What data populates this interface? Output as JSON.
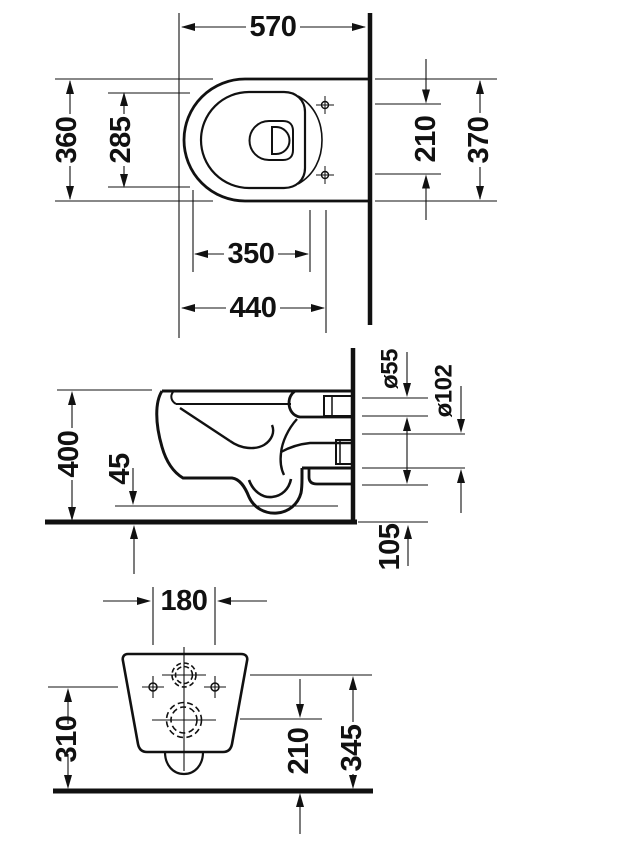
{
  "drawing": {
    "type": "technical dimension drawing",
    "subject": "wall-hung toilet",
    "line_color": "#111111",
    "background": "#ffffff"
  },
  "views": {
    "top": {
      "label": "top view",
      "dims": {
        "overall_length": "570",
        "overall_width": "360",
        "seat_opening_width": "285",
        "seat_opening_length": "350",
        "front_to_fixing": "440",
        "fixing_hole_spacing": "210",
        "width_at_wall": "370"
      }
    },
    "side": {
      "label": "side view",
      "dims": {
        "height": "400",
        "bottom_clearance": "45",
        "inlet_diameter": "ø55",
        "outlet_diameter": "ø102",
        "bottom_rear_height": "105"
      }
    },
    "rear": {
      "label": "rear view",
      "dims": {
        "fixing_hole_spacing": "180",
        "fixing_height": "310",
        "outlet_center_height": "210",
        "inlet_center_height": "345"
      }
    }
  }
}
